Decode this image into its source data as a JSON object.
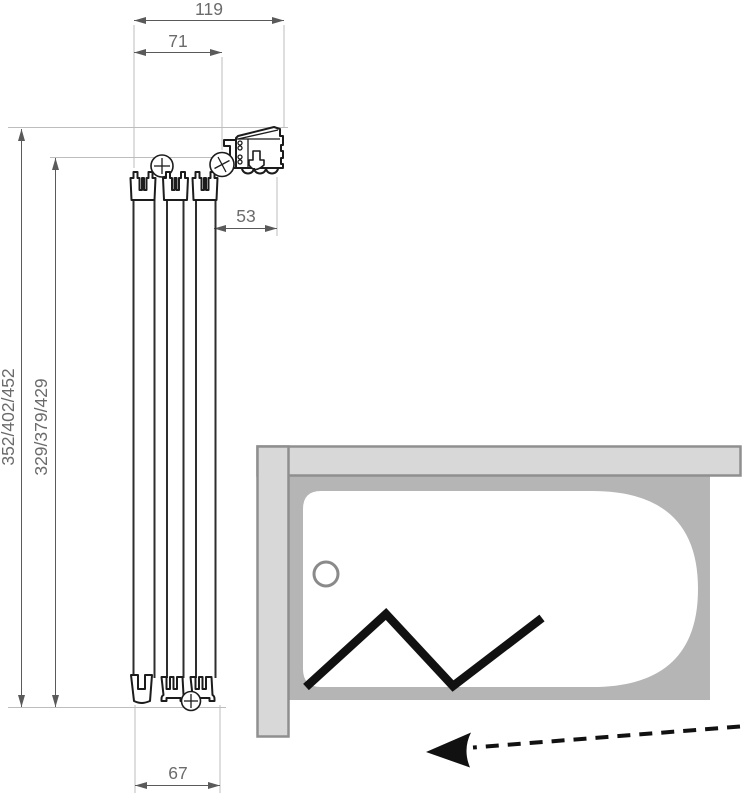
{
  "drawing": {
    "type": "bath-screen installation diagram",
    "dimensions": {
      "frame_width": "119",
      "glass_width": "71",
      "wall_clearance": "53",
      "total_heights": "352/402/452",
      "glass_heights": "329/379/429",
      "stack_width": "67"
    },
    "icons": [
      "screw-head-icon",
      "screw-head-icon",
      "screw-head-icon",
      "fold-direction-arrow-icon",
      "drain-circle-icon"
    ],
    "colors": {
      "wall_fill": "#d8d8d8",
      "wall_stroke": "#8f8f8f",
      "tub_fill": "#b5b5b5",
      "profile_outline": "#1c1c1c",
      "dimension_line": "#5a5a5a",
      "dimension_text": "#6b6b6b",
      "extension_line": "#bdbdbd",
      "arrow_black": "#111111"
    }
  }
}
